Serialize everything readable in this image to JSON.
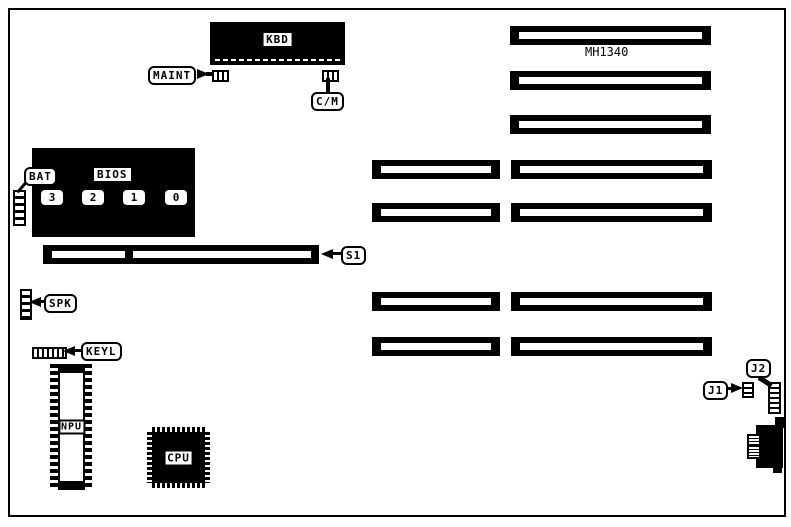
{
  "board": {
    "model": "MH1340"
  },
  "labels": {
    "kbd": "KBD",
    "maint": "MAINT",
    "cm": "C/M",
    "bat": "BAT",
    "bios": "BIOS",
    "bios_chips": [
      "3",
      "2",
      "1",
      "0"
    ],
    "s1": "S1",
    "spk": "SPK",
    "keyl": "KEYL",
    "npu": "NPU",
    "cpu": "CPU",
    "j1": "J1",
    "j2": "J2"
  },
  "colors": {
    "ink": "#000000",
    "paper": "#ffffff"
  }
}
